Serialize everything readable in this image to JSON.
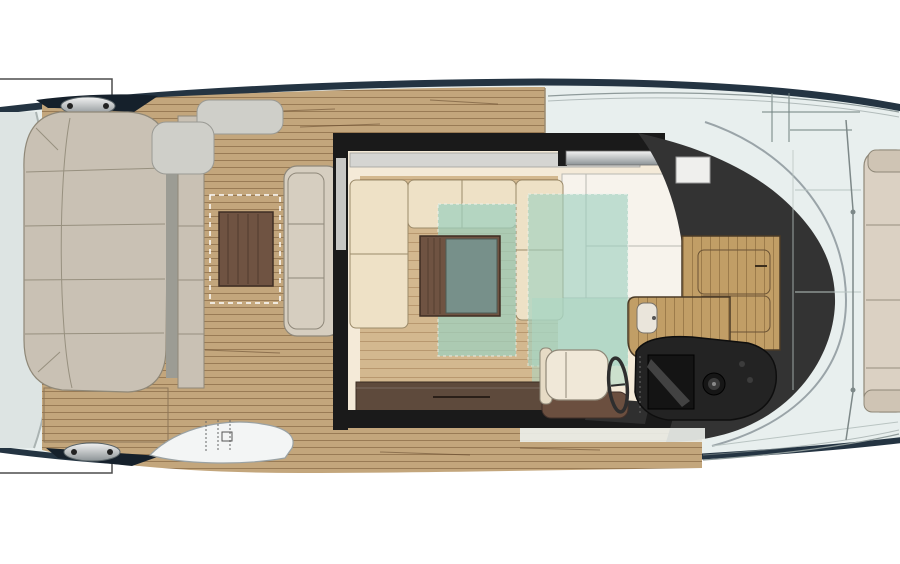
{
  "document": {
    "type": "yacht-main-deck-floor-plan",
    "description": "Top-down plan of a motor yacht main deck; bow to the right (cropped at both left and right edges), stern sun pad and teak cockpit aft, salon with sofas and rugs midships, galley and helm station forward, bow sun pad at far right.",
    "visible_text": ""
  },
  "canvas": {
    "width": 900,
    "height": 564,
    "background": "#ffffff"
  },
  "palette": {
    "background": "#ffffff",
    "hull_fill": "#e8efee",
    "hull_stroke": "#1c2834",
    "hull_band": "#243442",
    "swim_platform": "#dde4e3",
    "platform_edge": "#aab3b2",
    "teak_base": "#c3a67c",
    "teak_line": "#7a5c38",
    "salon_cream": "#f4ead8",
    "salon_wood_floor": "#d3b88f",
    "sofa_cream": "#eee1c6",
    "sofa_outline": "#9b8a6a",
    "rug_teal": "#9ed1c0",
    "rug_teal_light": "#abd7c4",
    "coffee_table_wood": "#6f5342",
    "coffee_table_top": "#77908a",
    "sideboard_wood": "#5e4a3c",
    "galley_wood": "#c19e66",
    "galley_line": "#4a3a26",
    "charcoal_structure": "#333333",
    "console_black": "#232323",
    "screen_black": "#141414",
    "seat_cream": "#f0e8d8",
    "seat_base_wood": "#6b4f3f",
    "stern_sunpad": "#c9c1b4",
    "sunpad_seam": "#97907f",
    "bench_gray": "#d6cec0",
    "bow_sunpad": "#dbd1c3",
    "step_gray": "#cfcfc9",
    "gate_white": "#f3f5f5",
    "white_panel": "#f7f3ec",
    "sill_gray": "#d5d5d2",
    "wall_black": "#1a1a1a",
    "wedge_dark": "#15202b",
    "annotation_line": "#4d4d4d",
    "rail_gray": "#8e9a9a",
    "deck_seam": "#b9c4c2"
  },
  "components": {
    "aft": [
      "swim-platform",
      "stern-sunpad",
      "mooring-cleats",
      "teak-cockpit",
      "cockpit-table",
      "cockpit-bench",
      "side-boarding-gate"
    ],
    "salon": [
      "sliding-door",
      "u-sofa",
      "area-rugs",
      "coffee-table",
      "tv-sideboard",
      "white-floor-panel"
    ],
    "forward": [
      "galley-counter",
      "galley-sink",
      "helm-seat",
      "steering-wheel",
      "helm-console",
      "windshield-frame",
      "foredeck",
      "bow-sunpad"
    ]
  }
}
